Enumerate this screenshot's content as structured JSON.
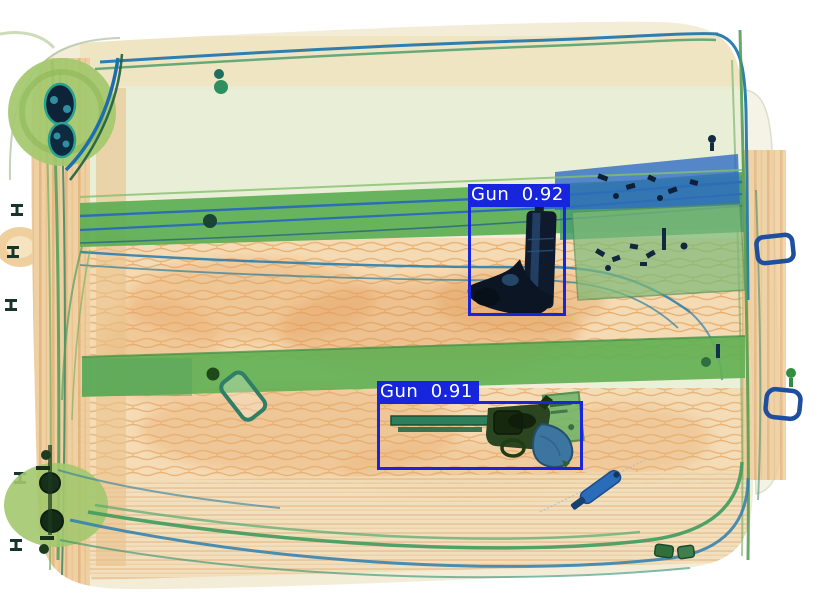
{
  "scene": {
    "type": "xray-baggage-scan",
    "description": "Security X-ray scan of a rolling suitcase; an object detector has drawn two blue bounding boxes around firearms hidden in the bag.",
    "background_color": "#ffffff",
    "visible_items": [
      "rolling suitcase shell with telescopic handle rails",
      "semi-automatic pistol (muzzle up)",
      "revolver (barrel pointing left) with green luggage tag",
      "two wheels with metal hubs (left side)",
      "green packing straps",
      "orange organic material (clothing)",
      "blue zipper pull",
      "two blue rectangular ring buckles"
    ]
  },
  "colors": {
    "detection_box": "#1726dd",
    "label_text": "#ffffff",
    "organic_orange": "#f3d9ae",
    "strap_green": "#5fae52",
    "shell_teal": "#2e7fae",
    "metal_dark": "#0f1b2d"
  },
  "detections": [
    {
      "label": "Gun",
      "score": "0.92",
      "display": "Gun  0.92",
      "box": {
        "x": 468,
        "y": 204,
        "w": 98,
        "h": 112
      }
    },
    {
      "label": "Gun",
      "score": "0.91",
      "display": "Gun  0.91",
      "box": {
        "x": 377,
        "y": 401,
        "w": 206,
        "h": 69
      }
    }
  ]
}
